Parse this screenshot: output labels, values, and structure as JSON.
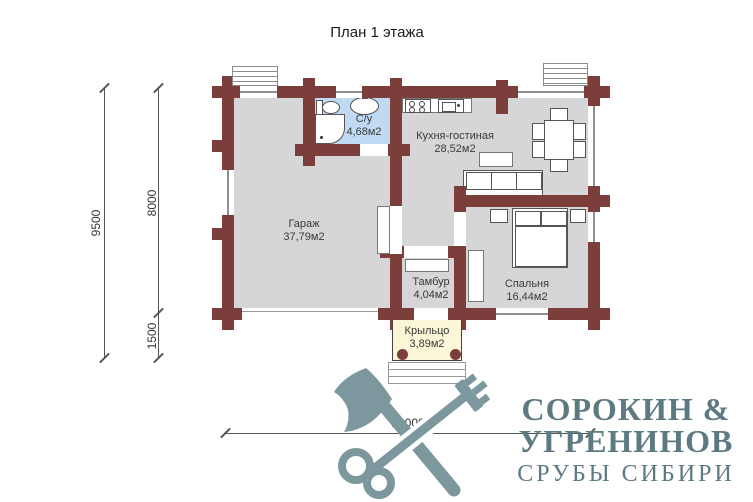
{
  "title": "План 1 этажа",
  "rooms": [
    {
      "id": "bathroom",
      "name": "С/у",
      "area": "4,68м2"
    },
    {
      "id": "kitchen-living",
      "name": "Кухня-гостиная",
      "area": "28,52м2"
    },
    {
      "id": "garage",
      "name": "Гараж",
      "area": "37,79м2"
    },
    {
      "id": "vestibule",
      "name": "Тамбур",
      "area": "4,04м2"
    },
    {
      "id": "bedroom",
      "name": "Спальня",
      "area": "16,44м2"
    },
    {
      "id": "porch",
      "name": "Крыльцо",
      "area": "3,89м2"
    }
  ],
  "dimensions": {
    "total_height": "9500",
    "upper_height": "8000",
    "lower_height": "1500",
    "total_width": "13000"
  },
  "logo": {
    "line1": "СОРОКИН  &",
    "line2": "УГРЕНИНОВ",
    "line3": "СРУБЫ СИБИРИ"
  },
  "icons": {
    "logo-mark": "crossed-axe-and-key",
    "toilet": "plan-symbol",
    "washbasin": "plan-symbol",
    "shower-cabin": "plan-symbol",
    "stove": "plan-symbol-4-burners",
    "kitchen-sink": "plan-symbol",
    "dining-table": "table-with-6-chairs",
    "sofa": "3-seat-sofa",
    "bed": "double-bed-2-pillows",
    "stairs": "porch-steps"
  },
  "colors": {
    "wall": "#7c3e3b",
    "floor": "#d6d6d8",
    "bath": "#bfdaf2",
    "porch": "#fbf6d7",
    "logo": "#5d7a82",
    "logoicon": "#7d979e"
  }
}
